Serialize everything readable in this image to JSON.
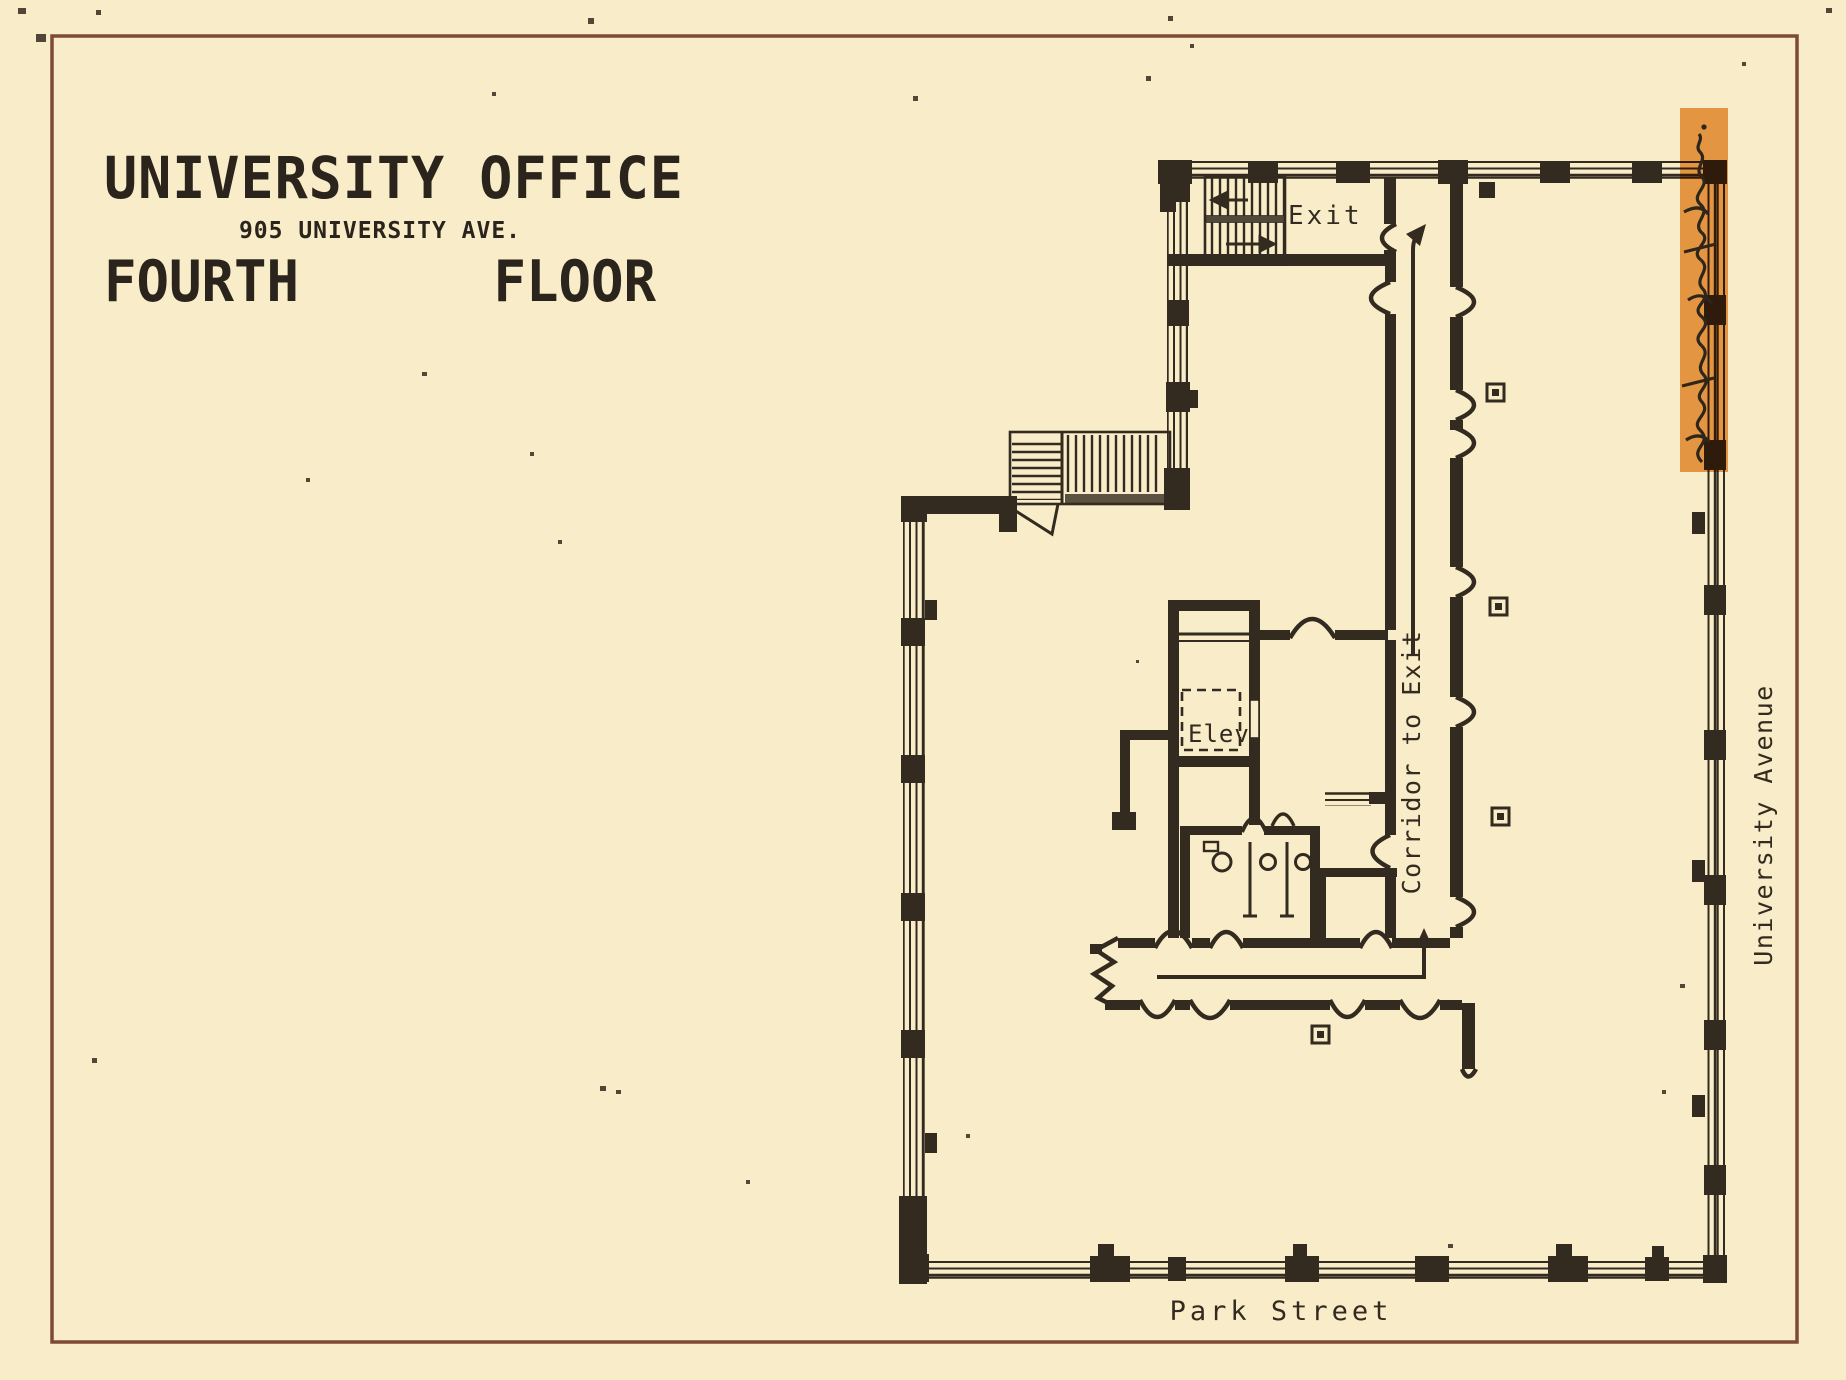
{
  "page": {
    "background_color": "#f8edc8",
    "border_color": "#7d4a37",
    "ink_color": "#332a20"
  },
  "title_block": {
    "building_name": "UNIVERSITY OFFICE",
    "address": "905 UNIVERSITY AVE.",
    "floor_left": "FOURTH",
    "floor_right": "FLOOR"
  },
  "plan": {
    "exit_label": "Exit",
    "elevator_label": "Elev.",
    "corridor_label": "Corridor to Exit",
    "street_right": "University Avenue",
    "street_bottom": "Park Street",
    "highlight": {
      "color": "#e8963f",
      "note": "(illegible cursive handwriting)"
    }
  }
}
